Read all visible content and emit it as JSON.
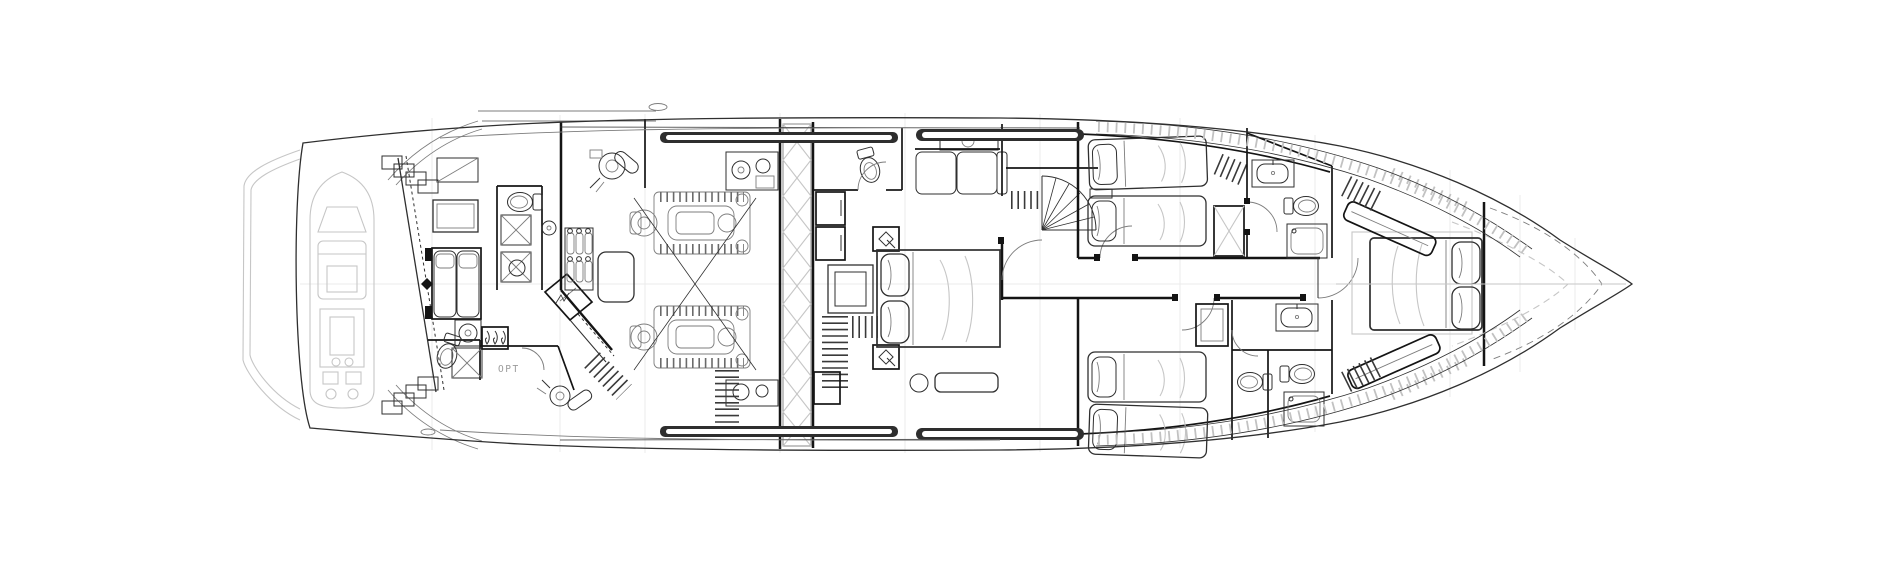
{
  "plan": {
    "labels": {
      "opt": "OPT"
    },
    "colors": {
      "paper": "#ffffff",
      "ink": "#2f2f2f",
      "wall": "#141414",
      "mid": "#7d7d7d",
      "ghost": "#c6c6c6",
      "grid": "#ebebeb",
      "band": "#2e2e2e"
    }
  }
}
